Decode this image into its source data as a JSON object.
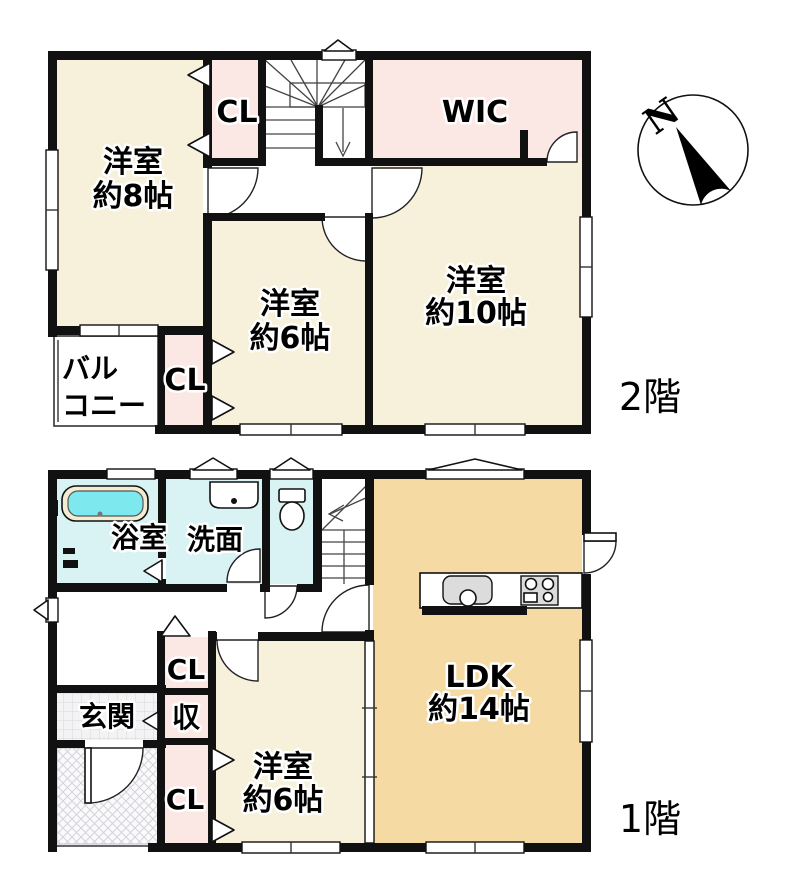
{
  "palette": {
    "cream": "#f7f1dc",
    "pink": "#fbe8e4",
    "tan": "#f5dba3",
    "aqua": "#d9f3f4",
    "tub_water": "#7de9ee",
    "wall": "#111111",
    "tile_bg": "#f3f3f5"
  },
  "floor2": {
    "label": "2階",
    "rooms": {
      "west_bedroom": {
        "l1": "洋室",
        "l2": "約8帖"
      },
      "closet_top": "CL",
      "wic": "WIC",
      "middle_bedroom": {
        "l1": "洋室",
        "l2": "約6帖"
      },
      "east_bedroom": {
        "l1": "洋室",
        "l2": "約10帖"
      },
      "balcony": {
        "l1": "バル",
        "l2": "コニー"
      },
      "closet_bottom": "CL"
    }
  },
  "floor1": {
    "label": "1階",
    "rooms": {
      "bathroom": "浴室",
      "washroom": "洗面",
      "entrance": "玄関",
      "storage": "収",
      "closet_mid": "CL",
      "closet_bottom": "CL",
      "bedroom": {
        "l1": "洋室",
        "l2": "約6帖"
      },
      "ldk": {
        "l1": "LDK",
        "l2": "約14帖"
      }
    }
  },
  "compass": {
    "north": "N"
  }
}
